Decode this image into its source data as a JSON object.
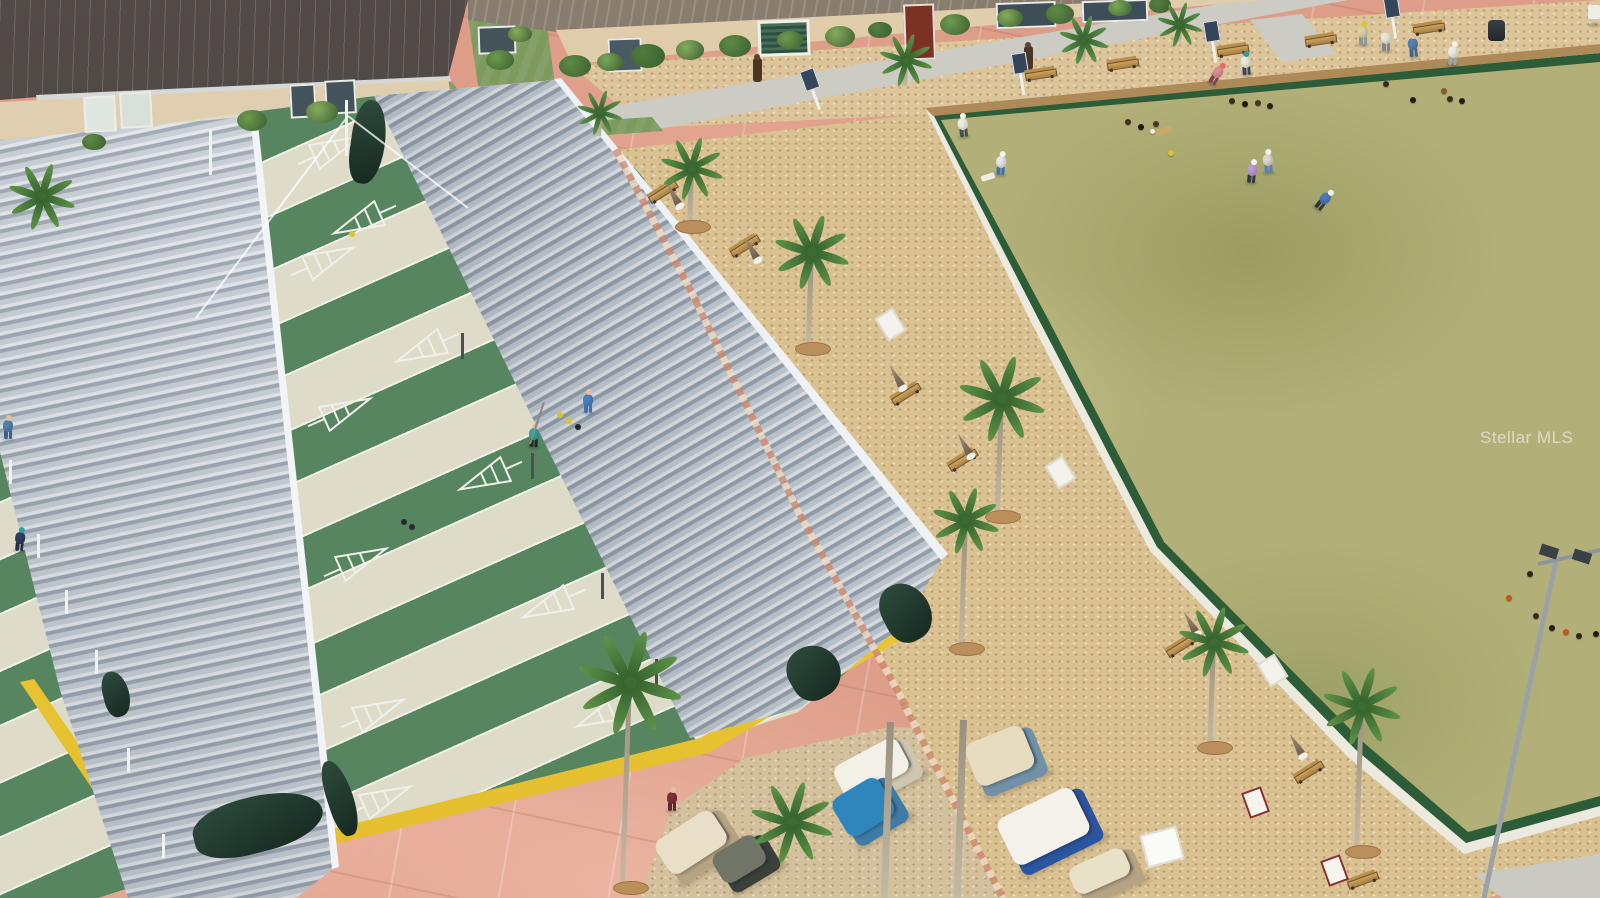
{
  "watermark": {
    "text": "Stellar MLS"
  },
  "colors": {
    "pavement": "#dd9d88",
    "mulch": "#d9c192",
    "bocce_green": "#b2b078",
    "bocce_edging": "#2d5c39",
    "court_green": "#56855f",
    "court_walkway": "#dedbc8",
    "roof_metal": "#c9d1d9",
    "yellow_trim": "#efcd39",
    "building_roof": "#474140",
    "building_wall": "#dccaab",
    "curtain_green": "#24402f",
    "grass": "#7d9a5f"
  },
  "scene": {
    "edging": [
      {
        "x": 656,
        "y": 225,
        "len": 172,
        "rot": 62
      },
      {
        "x": 748,
        "y": 408,
        "len": 240,
        "rot": 64
      },
      {
        "x": 853,
        "y": 610,
        "len": 218,
        "rot": 61
      },
      {
        "x": 953,
        "y": 800,
        "len": 220,
        "rot": 63
      }
    ],
    "windows": [
      {
        "x": 84,
        "y": 96,
        "w": 28,
        "h": 32,
        "c": "#dfe6df",
        "rot": -3
      },
      {
        "x": 120,
        "y": 92,
        "w": 28,
        "h": 32,
        "c": "#d8e0da",
        "rot": -3
      },
      {
        "x": 290,
        "y": 84,
        "w": 22,
        "h": 30,
        "c": "#44535c",
        "rot": -3
      },
      {
        "x": 325,
        "y": 80,
        "w": 27,
        "h": 30,
        "c": "#44535c",
        "rot": -3
      },
      {
        "x": 996,
        "y": 2,
        "w": 56,
        "h": 22,
        "c": "#3e4e58",
        "rot": -2
      },
      {
        "x": 1082,
        "y": 0,
        "w": 62,
        "h": 18,
        "c": "#3e4e58",
        "rot": -2
      },
      {
        "x": 608,
        "y": 38,
        "w": 30,
        "h": 30,
        "c": "#4a5a62",
        "rot": -2
      },
      {
        "x": 478,
        "y": 26,
        "w": 34,
        "h": 24,
        "c": "#44535c",
        "rot": -2
      }
    ],
    "bushes": [
      {
        "x": 575,
        "y": 66,
        "r": 16,
        "c": "#5e8a46"
      },
      {
        "x": 610,
        "y": 62,
        "r": 13,
        "c": "#7aa85a"
      },
      {
        "x": 648,
        "y": 56,
        "r": 17,
        "c": "#4f7c3e"
      },
      {
        "x": 690,
        "y": 50,
        "r": 14,
        "c": "#86ac5c"
      },
      {
        "x": 735,
        "y": 46,
        "r": 16,
        "c": "#5e8a46"
      },
      {
        "x": 790,
        "y": 40,
        "r": 13,
        "c": "#6e9a50"
      },
      {
        "x": 840,
        "y": 36,
        "r": 15,
        "c": "#86ac5c"
      },
      {
        "x": 880,
        "y": 30,
        "r": 12,
        "c": "#557f40"
      },
      {
        "x": 955,
        "y": 24,
        "r": 15,
        "c": "#6e9a50"
      },
      {
        "x": 1010,
        "y": 18,
        "r": 13,
        "c": "#86ac5c"
      },
      {
        "x": 1060,
        "y": 14,
        "r": 14,
        "c": "#5e8a46"
      },
      {
        "x": 1120,
        "y": 8,
        "r": 12,
        "c": "#7aa85a"
      },
      {
        "x": 1160,
        "y": 5,
        "r": 11,
        "c": "#557f40"
      },
      {
        "x": 252,
        "y": 120,
        "r": 15,
        "c": "#6e9a50"
      },
      {
        "x": 322,
        "y": 112,
        "r": 16,
        "c": "#86ac5c"
      },
      {
        "x": 94,
        "y": 142,
        "r": 12,
        "c": "#5e8a46"
      },
      {
        "x": 500,
        "y": 60,
        "r": 14,
        "c": "#6e9a50"
      },
      {
        "x": 520,
        "y": 34,
        "r": 12,
        "c": "#86ac5c"
      }
    ],
    "triangles": [
      {
        "x": 364,
        "y": 220,
        "f": 0
      },
      {
        "x": 427,
        "y": 348,
        "f": 0
      },
      {
        "x": 490,
        "y": 476,
        "f": 0
      },
      {
        "x": 553,
        "y": 604,
        "f": 0
      },
      {
        "x": 607,
        "y": 713,
        "f": 0
      },
      {
        "x": 323,
        "y": 261,
        "f": 1
      },
      {
        "x": 340,
        "y": 412,
        "f": 1
      },
      {
        "x": 356,
        "y": 562,
        "f": 1
      },
      {
        "x": 373,
        "y": 713,
        "f": 1
      },
      {
        "x": 380,
        "y": 800,
        "f": 1
      },
      {
        "x": 330,
        "y": 150,
        "f": 1
      }
    ],
    "discs": [
      {
        "x": 560,
        "y": 415,
        "c": "#d9c32e"
      },
      {
        "x": 569,
        "y": 421,
        "c": "#d9c32e"
      },
      {
        "x": 578,
        "y": 427,
        "c": "#222222"
      },
      {
        "x": 352,
        "y": 234,
        "c": "#d9c32e"
      },
      {
        "x": 404,
        "y": 522,
        "c": "#2a2a2a"
      },
      {
        "x": 412,
        "y": 527,
        "c": "#2a2a2a"
      }
    ],
    "balls": [
      {
        "x": 1128,
        "y": 122,
        "c": "#42301f"
      },
      {
        "x": 1141,
        "y": 127,
        "c": "#1d1812"
      },
      {
        "x": 1156,
        "y": 124,
        "c": "#4a3524"
      },
      {
        "x": 1152,
        "y": 131,
        "c": "#f2efe2",
        "r": 2.5
      },
      {
        "x": 1171,
        "y": 153,
        "c": "#d9c32e"
      },
      {
        "x": 1232,
        "y": 101,
        "c": "#3a2c1c"
      },
      {
        "x": 1245,
        "y": 104,
        "c": "#201a12"
      },
      {
        "x": 1258,
        "y": 103,
        "c": "#463322"
      },
      {
        "x": 1270,
        "y": 106,
        "c": "#2a2018"
      },
      {
        "x": 1386,
        "y": 84,
        "c": "#3a2c1c"
      },
      {
        "x": 1413,
        "y": 100,
        "c": "#231c14"
      },
      {
        "x": 1444,
        "y": 91,
        "c": "#8a5a2e"
      },
      {
        "x": 1450,
        "y": 99,
        "c": "#3a2c1c"
      },
      {
        "x": 1462,
        "y": 101,
        "c": "#231c14"
      },
      {
        "x": 1530,
        "y": 574,
        "c": "#2e2418"
      },
      {
        "x": 1509,
        "y": 598,
        "c": "#c2571f"
      },
      {
        "x": 1536,
        "y": 616,
        "c": "#3a2a1a"
      },
      {
        "x": 1552,
        "y": 628,
        "c": "#241c12"
      },
      {
        "x": 1566,
        "y": 632,
        "c": "#c2571f"
      },
      {
        "x": 1579,
        "y": 636,
        "c": "#2e2418"
      },
      {
        "x": 1596,
        "y": 634,
        "c": "#241c12"
      }
    ],
    "mats": [
      {
        "x": 1163,
        "y": 131,
        "w": 17,
        "h": 6,
        "c": "#c9a96a",
        "rot": -18
      },
      {
        "x": 988,
        "y": 177,
        "w": 14,
        "h": 6,
        "c": "#efede4",
        "rot": -18
      }
    ],
    "benches": [
      {
        "x": 1040,
        "y": 74,
        "rot": -9
      },
      {
        "x": 1122,
        "y": 64,
        "rot": -9
      },
      {
        "x": 1232,
        "y": 50,
        "rot": -9
      },
      {
        "x": 1320,
        "y": 40,
        "rot": -9
      },
      {
        "x": 1428,
        "y": 28,
        "rot": -9
      },
      {
        "x": 662,
        "y": 192,
        "rot": -32
      },
      {
        "x": 744,
        "y": 246,
        "rot": -32
      },
      {
        "x": 905,
        "y": 394,
        "rot": -32
      },
      {
        "x": 962,
        "y": 460,
        "rot": -32
      },
      {
        "x": 1180,
        "y": 646,
        "rot": -32
      },
      {
        "x": 1308,
        "y": 772,
        "rot": -32
      },
      {
        "x": 1362,
        "y": 880,
        "rot": -20
      }
    ],
    "umbrellas": [
      {
        "x": 674,
        "y": 196,
        "rot": -30
      },
      {
        "x": 752,
        "y": 250,
        "rot": -30
      },
      {
        "x": 897,
        "y": 378,
        "rot": -30
      },
      {
        "x": 965,
        "y": 446,
        "rot": -30
      },
      {
        "x": 1191,
        "y": 624,
        "rot": -30
      },
      {
        "x": 1297,
        "y": 746,
        "rot": -30
      }
    ],
    "signs": [
      {
        "x": 888,
        "y": 322,
        "rot": -32,
        "c": "#f4f2ec",
        "b": "#dddbd2"
      },
      {
        "x": 1058,
        "y": 470,
        "rot": -32,
        "c": "#f4f2ec",
        "b": "#dddbd2"
      },
      {
        "x": 1270,
        "y": 668,
        "rot": -32,
        "c": "#f4f2ec",
        "b": "#dddbd2"
      },
      {
        "x": 1253,
        "y": 800,
        "rot": -20,
        "c": "#f6f4ee",
        "b": "#8a3030"
      },
      {
        "x": 1332,
        "y": 868,
        "rot": -20,
        "c": "#f6f4ee",
        "b": "#8a3030"
      },
      {
        "x": 1160,
        "y": 845,
        "rot": -15,
        "c": "#fafaf6",
        "b": "#e0ddd2",
        "w": 34,
        "h": 30
      }
    ],
    "scoreboards": [
      {
        "x": 1020,
        "y": 74,
        "rot": -9
      },
      {
        "x": 1212,
        "y": 42,
        "rot": -9
      },
      {
        "x": 1392,
        "y": 18,
        "rot": -9
      },
      {
        "x": 812,
        "y": 90,
        "rot": -20
      }
    ],
    "tikis": [
      {
        "x": 757,
        "y": 68
      },
      {
        "x": 1028,
        "y": 56
      }
    ],
    "posts_dark": [
      {
        "x": 462,
        "y": 346
      },
      {
        "x": 532,
        "y": 466
      },
      {
        "x": 602,
        "y": 586
      },
      {
        "x": 656,
        "y": 672
      }
    ],
    "posts_white": [
      {
        "x": 10,
        "y": 472
      },
      {
        "x": 38,
        "y": 546
      },
      {
        "x": 66,
        "y": 602
      },
      {
        "x": 96,
        "y": 662
      },
      {
        "x": 128,
        "y": 760
      },
      {
        "x": 163,
        "y": 846
      },
      {
        "x": 210,
        "y": 152,
        "h": 46
      },
      {
        "x": 346,
        "y": 128,
        "h": 56
      }
    ],
    "curtains": [
      {
        "x": 368,
        "y": 142,
        "w": 34,
        "h": 84,
        "rot": 8
      },
      {
        "x": 258,
        "y": 824,
        "w": 132,
        "h": 56,
        "rot": -14
      },
      {
        "x": 340,
        "y": 798,
        "w": 26,
        "h": 78,
        "rot": -18
      },
      {
        "x": 906,
        "y": 612,
        "w": 48,
        "h": 60,
        "rot": -28
      },
      {
        "x": 814,
        "y": 672,
        "w": 52,
        "h": 54,
        "rot": -30
      },
      {
        "x": 116,
        "y": 694,
        "w": 26,
        "h": 46,
        "rot": -14
      }
    ],
    "wires": [
      {
        "x1": 348,
        "y1": 116,
        "x2": 196,
        "y2": 318
      },
      {
        "x1": 348,
        "y1": 116,
        "x2": 468,
        "y2": 208
      }
    ],
    "palms": [
      {
        "x": 600,
        "y": 112,
        "s": 0.6,
        "trunk": 24
      },
      {
        "x": 692,
        "y": 168,
        "s": 0.8,
        "trunk": 58
      },
      {
        "x": 812,
        "y": 252,
        "s": 0.95,
        "trunk": 96
      },
      {
        "x": 1002,
        "y": 398,
        "s": 1.1,
        "trunk": 118
      },
      {
        "x": 966,
        "y": 520,
        "s": 0.85,
        "trunk": 128
      },
      {
        "x": 1214,
        "y": 642,
        "s": 0.9,
        "trunk": 105
      },
      {
        "x": 1362,
        "y": 706,
        "s": 1.0,
        "trunk": 145
      },
      {
        "x": 630,
        "y": 682,
        "s": 1.3,
        "trunk": 205
      },
      {
        "x": 792,
        "y": 822,
        "s": 1.05,
        "trunk": 0
      },
      {
        "x": 42,
        "y": 196,
        "s": 0.85,
        "trunk": 0
      },
      {
        "x": 906,
        "y": 60,
        "s": 0.7,
        "trunk": 26
      },
      {
        "x": 1084,
        "y": 40,
        "s": 0.65,
        "trunk": 22
      },
      {
        "x": 1180,
        "y": 24,
        "s": 0.6,
        "trunk": 18
      },
      {
        "x": 890,
        "y": 722,
        "s": 0,
        "trunk": 176
      },
      {
        "x": 963,
        "y": 720,
        "s": 0,
        "trunk": 178
      }
    ],
    "people": [
      {
        "x": 8,
        "y": 428,
        "shirt": "#4f7fae",
        "pants": "#3a5f8a",
        "rot": 0
      },
      {
        "x": 20,
        "y": 540,
        "shirt": "#303c5c",
        "pants": "#262e48",
        "hat": "#2f9aa4",
        "rot": 5
      },
      {
        "x": 534,
        "y": 436,
        "shirt": "#2aa39b",
        "pants": "#23262a",
        "rot": 3,
        "cue": 1
      },
      {
        "x": 588,
        "y": 402,
        "shirt": "#4a7fc0",
        "pants": "#3f6fae",
        "rot": 0
      },
      {
        "x": 672,
        "y": 800,
        "shirt": "#79303a",
        "pants": "#5d2730",
        "rot": 0
      },
      {
        "x": 963,
        "y": 126,
        "shirt": "#efece2",
        "pants": "#4a4f55",
        "hat": "#f2f2ee",
        "rot": -6
      },
      {
        "x": 1001,
        "y": 164,
        "shirt": "#e6e4ee",
        "pants": "#3f6fae",
        "hat": "#f2f2ee",
        "rot": 4
      },
      {
        "x": 1217,
        "y": 74,
        "shirt": "#d98f8f",
        "pants": "#7c4650",
        "hat": "#e06a70",
        "rot": 30
      },
      {
        "x": 1246,
        "y": 64,
        "shirt": "#ebe8dc",
        "pants": "#39495a",
        "hat": "#2f9aa4",
        "rot": -4
      },
      {
        "x": 1252,
        "y": 172,
        "shirt": "#b79bd1",
        "pants": "#35353f",
        "hat": "#f2f2ee",
        "rot": 6
      },
      {
        "x": 1268,
        "y": 162,
        "shirt": "#dbd7cb",
        "pants": "#5a80b2",
        "hat": "#f2f2ee",
        "rot": -4
      },
      {
        "x": 1324,
        "y": 200,
        "shirt": "#4a78b8",
        "pants": "#35353b",
        "hat": "#f2f2ee",
        "rot": 38
      },
      {
        "x": 1363,
        "y": 34,
        "shirt": "#d9d0a2",
        "pants": "#8e9699",
        "hat": "#d9c32e",
        "rot": 0
      },
      {
        "x": 1386,
        "y": 40,
        "shirt": "#e9e6db",
        "pants": "#7a8894",
        "rot": 0
      },
      {
        "x": 1413,
        "y": 46,
        "shirt": "#5580b0",
        "pants": "#44668a",
        "rot": -5
      },
      {
        "x": 1453,
        "y": 54,
        "shirt": "#edeae1",
        "pants": "#9aa4ae",
        "hat": "#f2f2ee",
        "rot": 4
      },
      {
        "x": 1594,
        "y": 14,
        "shirt": "#e8e8e6",
        "rot": 0
      }
    ],
    "carts": [
      {
        "x": 700,
        "y": 845,
        "w": 80,
        "h": 54,
        "rot": -33,
        "roof": "#e9dfc8",
        "body": "#b5a383"
      },
      {
        "x": 880,
        "y": 772,
        "w": 84,
        "h": 52,
        "rot": -28,
        "roof": "#f3f0e7",
        "body": "#cfc6b0"
      },
      {
        "x": 1008,
        "y": 760,
        "w": 74,
        "h": 60,
        "rot": -22,
        "roof": "#e7dcc0",
        "body": "#7291a8"
      },
      {
        "x": 1052,
        "y": 830,
        "w": 96,
        "h": 66,
        "rot": -26,
        "roof": "#f4f2ea",
        "body": "#2b55a0"
      },
      {
        "x": 1108,
        "y": 875,
        "w": 72,
        "h": 44,
        "rot": -24,
        "roof": "#e9e0c8",
        "body": "#b5a383"
      },
      {
        "x": 872,
        "y": 810,
        "w": 66,
        "h": 58,
        "rot": -31,
        "roof": "#2f86bc",
        "body": "#3f7ba8"
      },
      {
        "x": 748,
        "y": 862,
        "w": 62,
        "h": 48,
        "rot": -31,
        "roof": "#707568",
        "body": "#3c403a"
      }
    ],
    "pole": {
      "x1": 1557,
      "y1": 556,
      "x2": 1484,
      "y2": 898,
      "arm": {
        "x1": 1538,
        "y1": 564,
        "x2": 1600,
        "y2": 550
      },
      "panels": [
        {
          "x": 1549,
          "y": 551,
          "rot": 18
        },
        {
          "x": 1582,
          "y": 556,
          "rot": 18
        }
      ]
    },
    "trash": {
      "x": 1496,
      "y": 30
    },
    "corner_object": {
      "x": 1594,
      "y": 12
    }
  }
}
